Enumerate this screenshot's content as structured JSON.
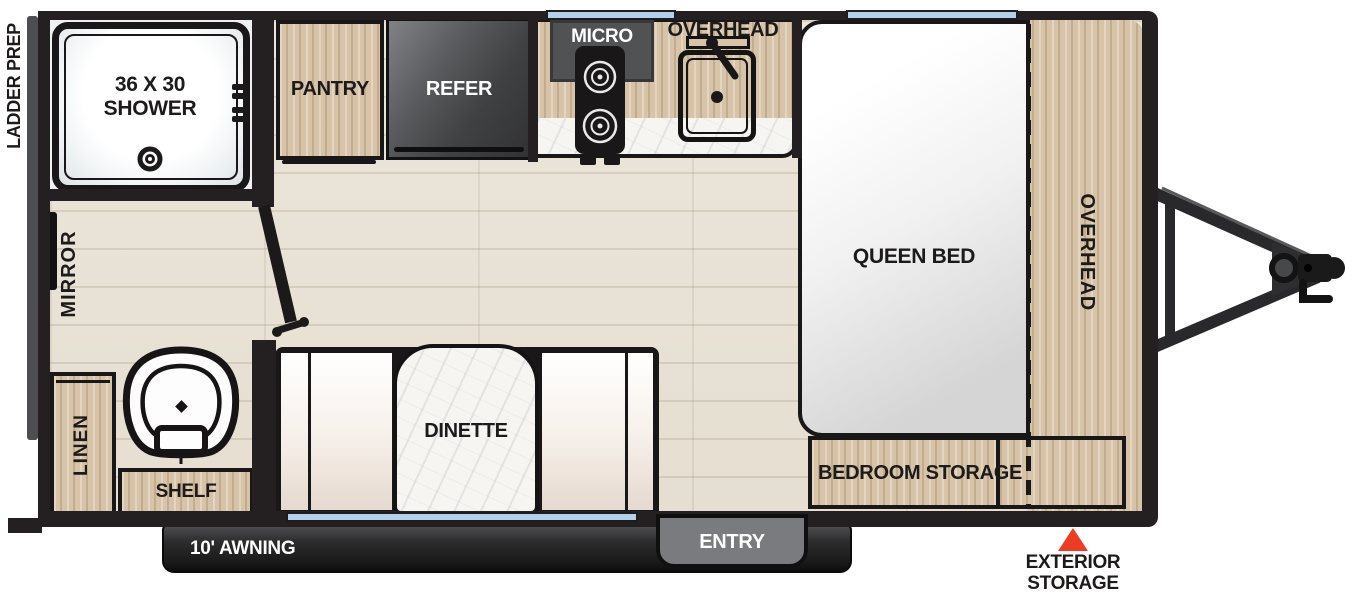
{
  "labels": {
    "ladder_prep": "LADDER PREP",
    "shower_line1": "36 X 30",
    "shower_line2": "SHOWER",
    "mirror": "MIRROR",
    "linen": "LINEN",
    "shelf": "SHELF",
    "pantry": "PANTRY",
    "refer": "REFER",
    "micro": "MICRO",
    "overhead_kitchen": "OVERHEAD",
    "overhead_bed": "OVERHEAD",
    "queen_bed": "QUEEN BED",
    "bedroom_storage": "BEDROOM STORAGE",
    "dinette": "DINETTE",
    "awning": "10' AWNING",
    "entry": "ENTRY",
    "exterior_storage_line1": "EXTERIOR",
    "exterior_storage_line2": "STORAGE"
  },
  "colors": {
    "wall": "#242021",
    "cabinet_wood": "#d7c3a7",
    "floor_wood": "#eae3d7",
    "window_blue": "#b4d0ea",
    "appliance_dark": "#47484a",
    "entry_gray": "#7a7b7e",
    "awning_dark": "#2a2a2b",
    "accent_red": "#ee3b24",
    "marble_white": "#f6f5f2"
  }
}
